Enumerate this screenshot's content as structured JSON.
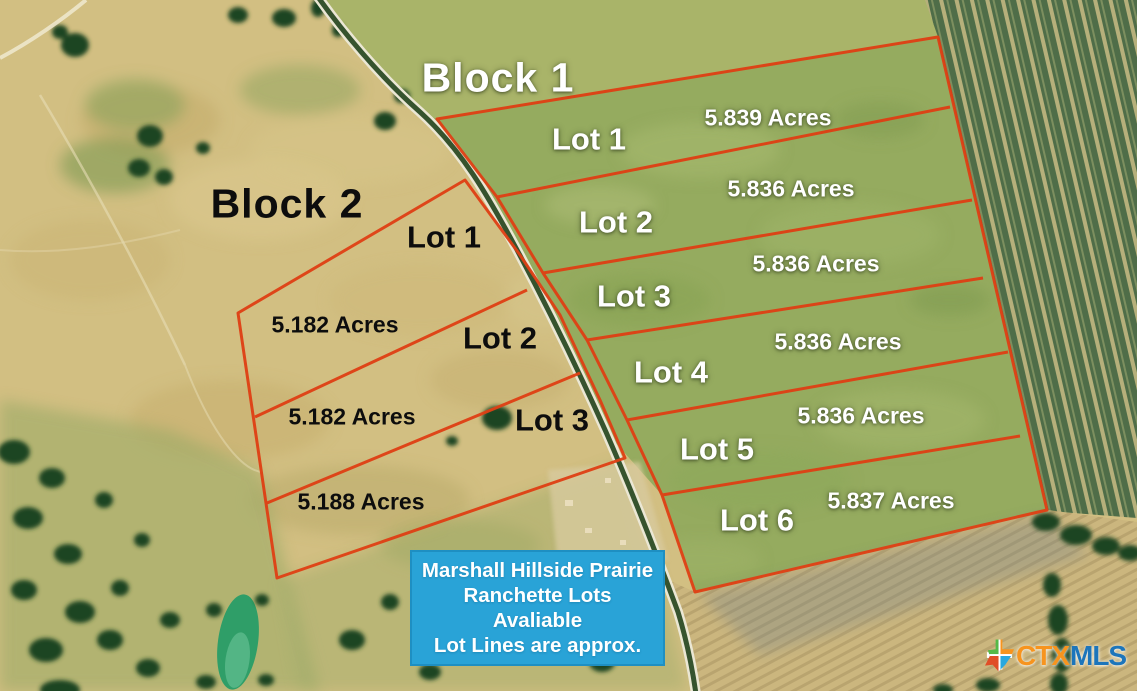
{
  "map": {
    "blocks": [
      {
        "title": "Block 1",
        "lots": [
          {
            "label": "Lot 1",
            "acres": "5.839 Acres"
          },
          {
            "label": "Lot 2",
            "acres": "5.836 Acres"
          },
          {
            "label": "Lot 3",
            "acres": "5.836 Acres"
          },
          {
            "label": "Lot 4",
            "acres": "5.836 Acres"
          },
          {
            "label": "Lot 5",
            "acres": "5.836 Acres"
          },
          {
            "label": "Lot 6",
            "acres": "5.837 Acres"
          }
        ]
      },
      {
        "title": "Block 2",
        "lots": [
          {
            "label": "Lot 1",
            "acres": "5.182 Acres"
          },
          {
            "label": "Lot 2",
            "acres": "5.182 Acres"
          },
          {
            "label": "Lot 3",
            "acres": "5.188 Acres"
          }
        ]
      }
    ],
    "info_box": {
      "lines": [
        "Marshall Hillside Prairie",
        "Ranchette Lots",
        "Avaliable",
        "Lot Lines are approx."
      ],
      "bg_color": "#29A3D7",
      "text_color": "#FFFFFF"
    },
    "watermark": {
      "prefix": "CTX",
      "suffix": "MLS",
      "prefix_color": "#F7941E",
      "suffix_color": "#1C75BB"
    },
    "lot_line_color": "#DF3F14"
  }
}
